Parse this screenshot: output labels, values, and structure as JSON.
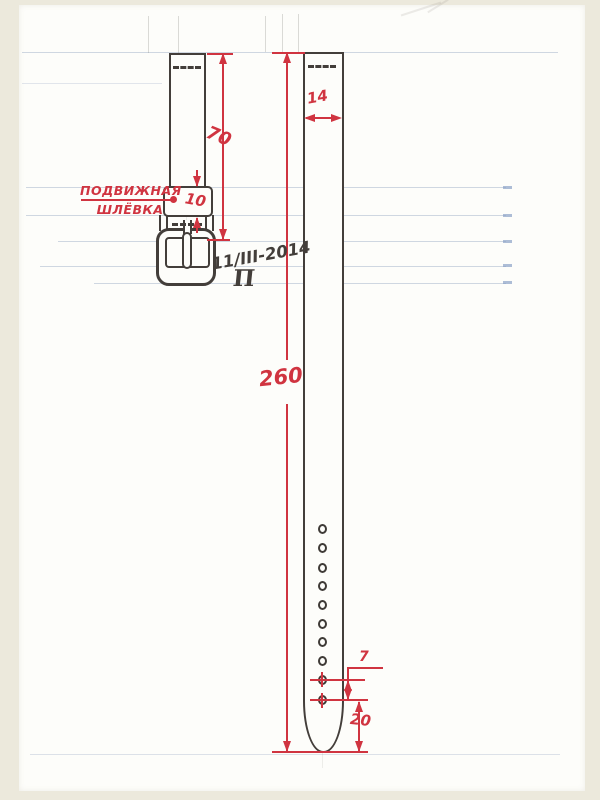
{
  "page": {
    "background_color": "#ece9dc",
    "paper_color": "#fdfdfa"
  },
  "colors": {
    "ink": "#433e3a",
    "dimension_red": "#d03440",
    "ruled_line_blue": "#96a8c4"
  },
  "labels": {
    "keeper_label_line1": "ПОДВИЖНАЯ",
    "keeper_label_line2": "ШЛЁВКА",
    "date": "11/III-2014",
    "monogram": "П"
  },
  "dimensions": {
    "buckle_piece_length": "70",
    "keeper_height": "10",
    "strap_width": "14",
    "strap_length": "260",
    "hole_pitch": "7",
    "tip_to_last_hole": "20"
  },
  "holes": {
    "count": 10
  }
}
